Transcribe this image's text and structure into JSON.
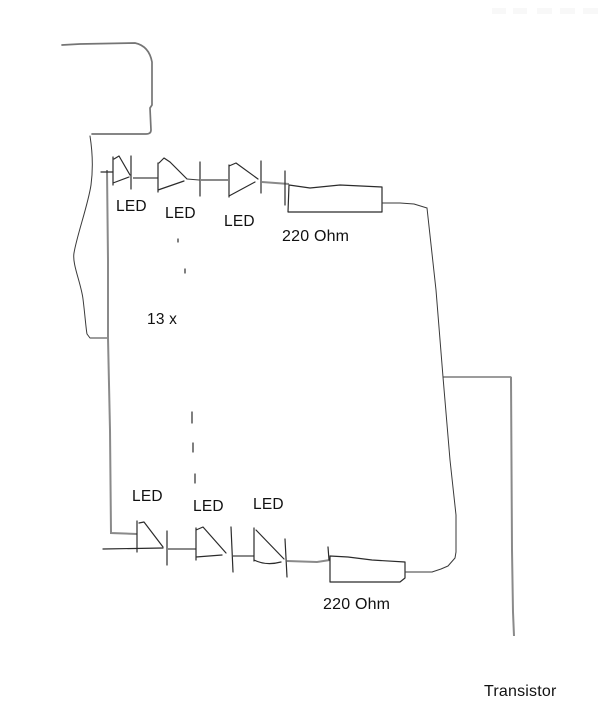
{
  "diagram": {
    "kind": "hand-drawn circuit schematic",
    "labels": {
      "led_top": [
        "LED",
        "LED",
        "LED"
      ],
      "led_bottom": [
        "LED",
        "LED",
        "LED"
      ],
      "resistor_top": "220 Ohm",
      "resistor_bottom": "220 Ohm",
      "multiplier": "13 x",
      "transistor": "Transistor"
    },
    "colors": {
      "background": "#ffffff",
      "ink": "#2b2b2b",
      "wire": "#757575"
    }
  }
}
